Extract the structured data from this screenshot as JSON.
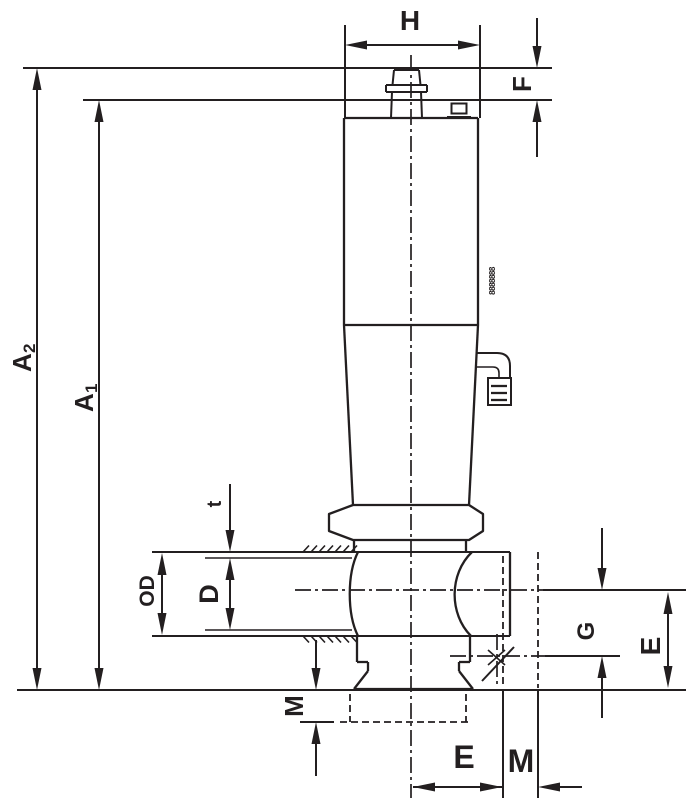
{
  "figure": {
    "colors": {
      "line": "#231f20",
      "bg": "#ffffff"
    },
    "labels": {
      "h": "H",
      "f": "F",
      "a2": {
        "base": "A",
        "sub": "2"
      },
      "a1": {
        "base": "A",
        "sub": "1"
      },
      "t": "t",
      "od": "OD",
      "d": "D",
      "m_left": "M",
      "e_bottom": "E",
      "m_bottom": "M",
      "g": "G",
      "e_right": "E",
      "stamp": "8888888"
    }
  }
}
